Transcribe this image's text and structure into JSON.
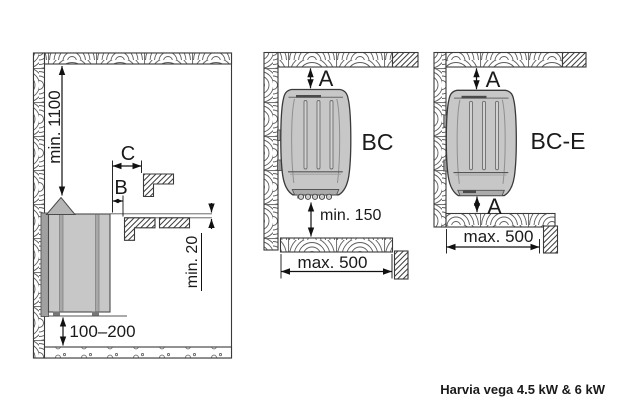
{
  "colors": {
    "background": "#ffffff",
    "line": "#3a3a3a",
    "dim": "#111111",
    "heater-fill": "#c7c7c7",
    "heater-dark": "#9e9e9e",
    "text": "#1a1a1a"
  },
  "caption": "Harvia vega 4.5 kW & 6 kW",
  "side_view": {
    "dim_ceiling": "min. 1100",
    "dim_c": "C",
    "dim_b": "B",
    "dim_bench_gap": "min. 20",
    "dim_floor": "100–200"
  },
  "bc": {
    "label": "BC",
    "dim_top": "A",
    "dim_below": "min. 150",
    "dim_width": "max. 500"
  },
  "bce": {
    "label": "BC-E",
    "dim_top": "A",
    "dim_bottom": "A",
    "dim_width": "max. 500"
  }
}
